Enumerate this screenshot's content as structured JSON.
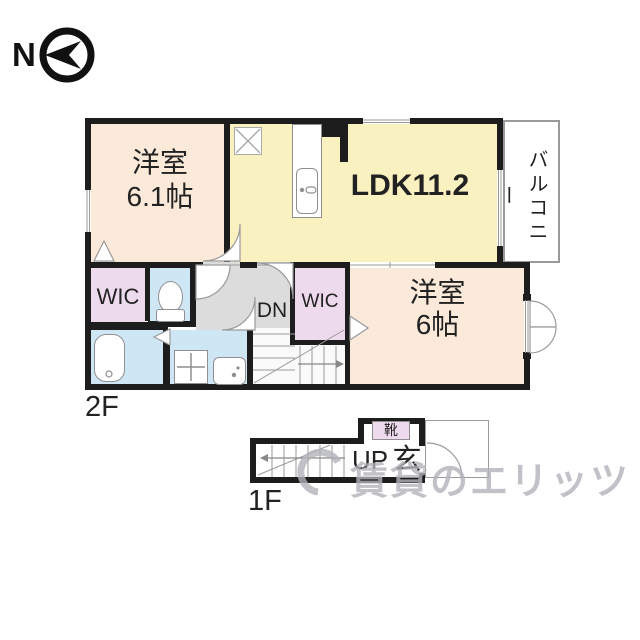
{
  "compass": {
    "north_label": "N"
  },
  "floor_2f": {
    "floor_label": "2F",
    "bedroom_main": {
      "name": "洋室",
      "size": "6.1帖"
    },
    "ldk": {
      "label": "LDK11.2"
    },
    "balcony": {
      "label": "バルコニー"
    },
    "wic_left": {
      "label": "WIC"
    },
    "wic_center": {
      "label": "WIC"
    },
    "bedroom_second": {
      "name": "洋室",
      "size": "6帖"
    },
    "stairs": {
      "direction_label": "DN"
    }
  },
  "floor_1f": {
    "floor_label": "1F",
    "stairs": {
      "direction_label": "UP"
    },
    "entrance": {
      "label": "玄"
    },
    "shoe_cabinet": {
      "label": "靴"
    }
  },
  "watermark": {
    "text": "賃貸のエリッツ"
  },
  "colors": {
    "wall": "#1d1d1d",
    "room_peach": "#fbe9d9",
    "room_yellow": "#faf1c0",
    "room_pink": "#eedaed",
    "room_blue": "#cfe7f5",
    "hallway_gray": "#dcdcdc",
    "stairs_bg": "#fafafa",
    "fixture_line": "#8f8f8f",
    "thin_line": "#9a9a9a",
    "watermark_gray": "#b2b2ba",
    "text_dark": "#222222"
  }
}
